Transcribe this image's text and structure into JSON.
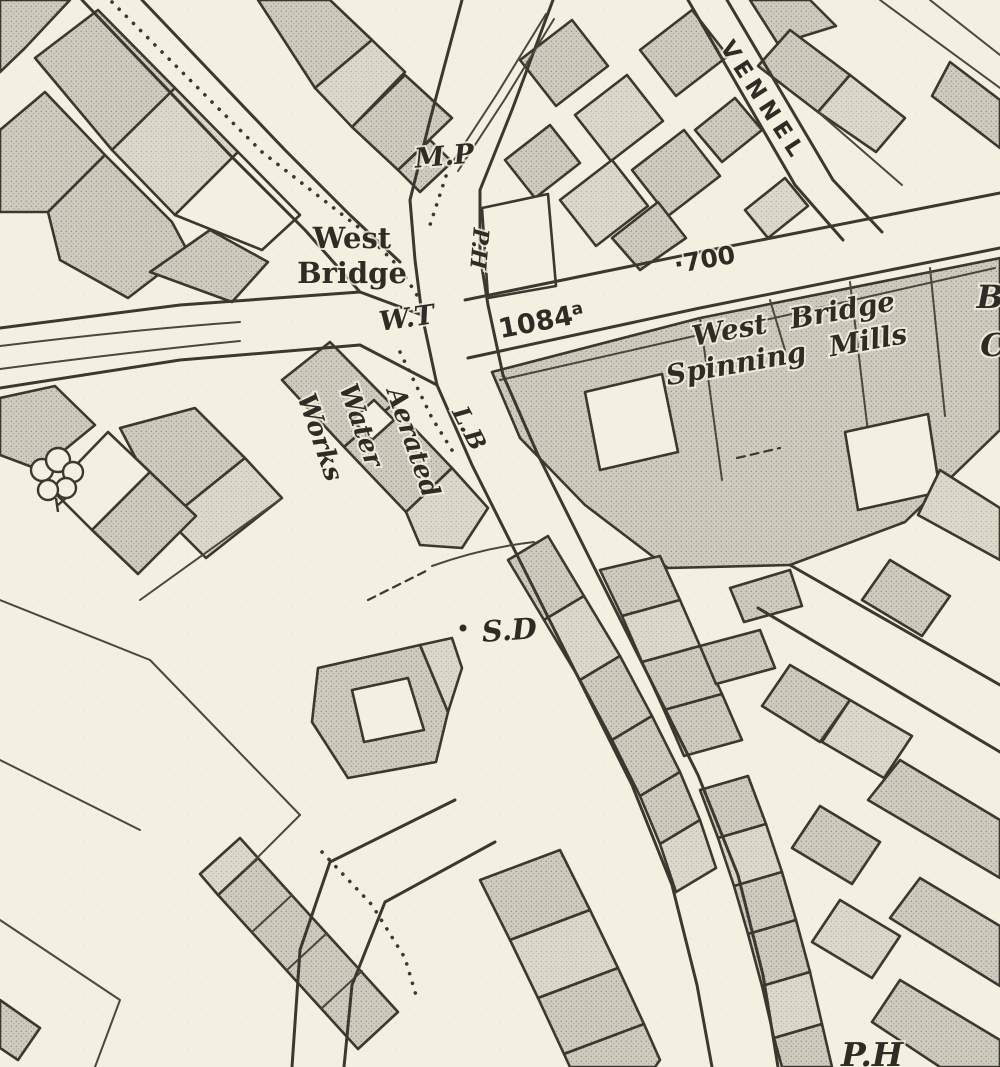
{
  "map": {
    "labels": {
      "mp": "M.P",
      "west_bridge_line1": "West",
      "west_bridge_line2": "Bridge",
      "wt": "W.T",
      "ph": "P.H",
      "parcel_number": "1084",
      "parcel_suffix": "a",
      "spot_height": "·700",
      "mills_line1": "West Bridge",
      "mills_line2": "Spinning Mills",
      "vennel": "VENNEL",
      "aerated_line1": "Aerated",
      "aerated_line2": "Water",
      "aerated_line3": "Works",
      "lb": "L.B",
      "sd": "S.D",
      "edge_right_line1": "B",
      "edge_right_line2": "C",
      "edge_bottom": "P.H"
    },
    "colors": {
      "paper": "#f4f0e1",
      "building_fill": "#cfccbf",
      "building_fill_light": "#dcd9cb",
      "ink": "#3b382f",
      "label_ink": "#2f2c25"
    }
  }
}
